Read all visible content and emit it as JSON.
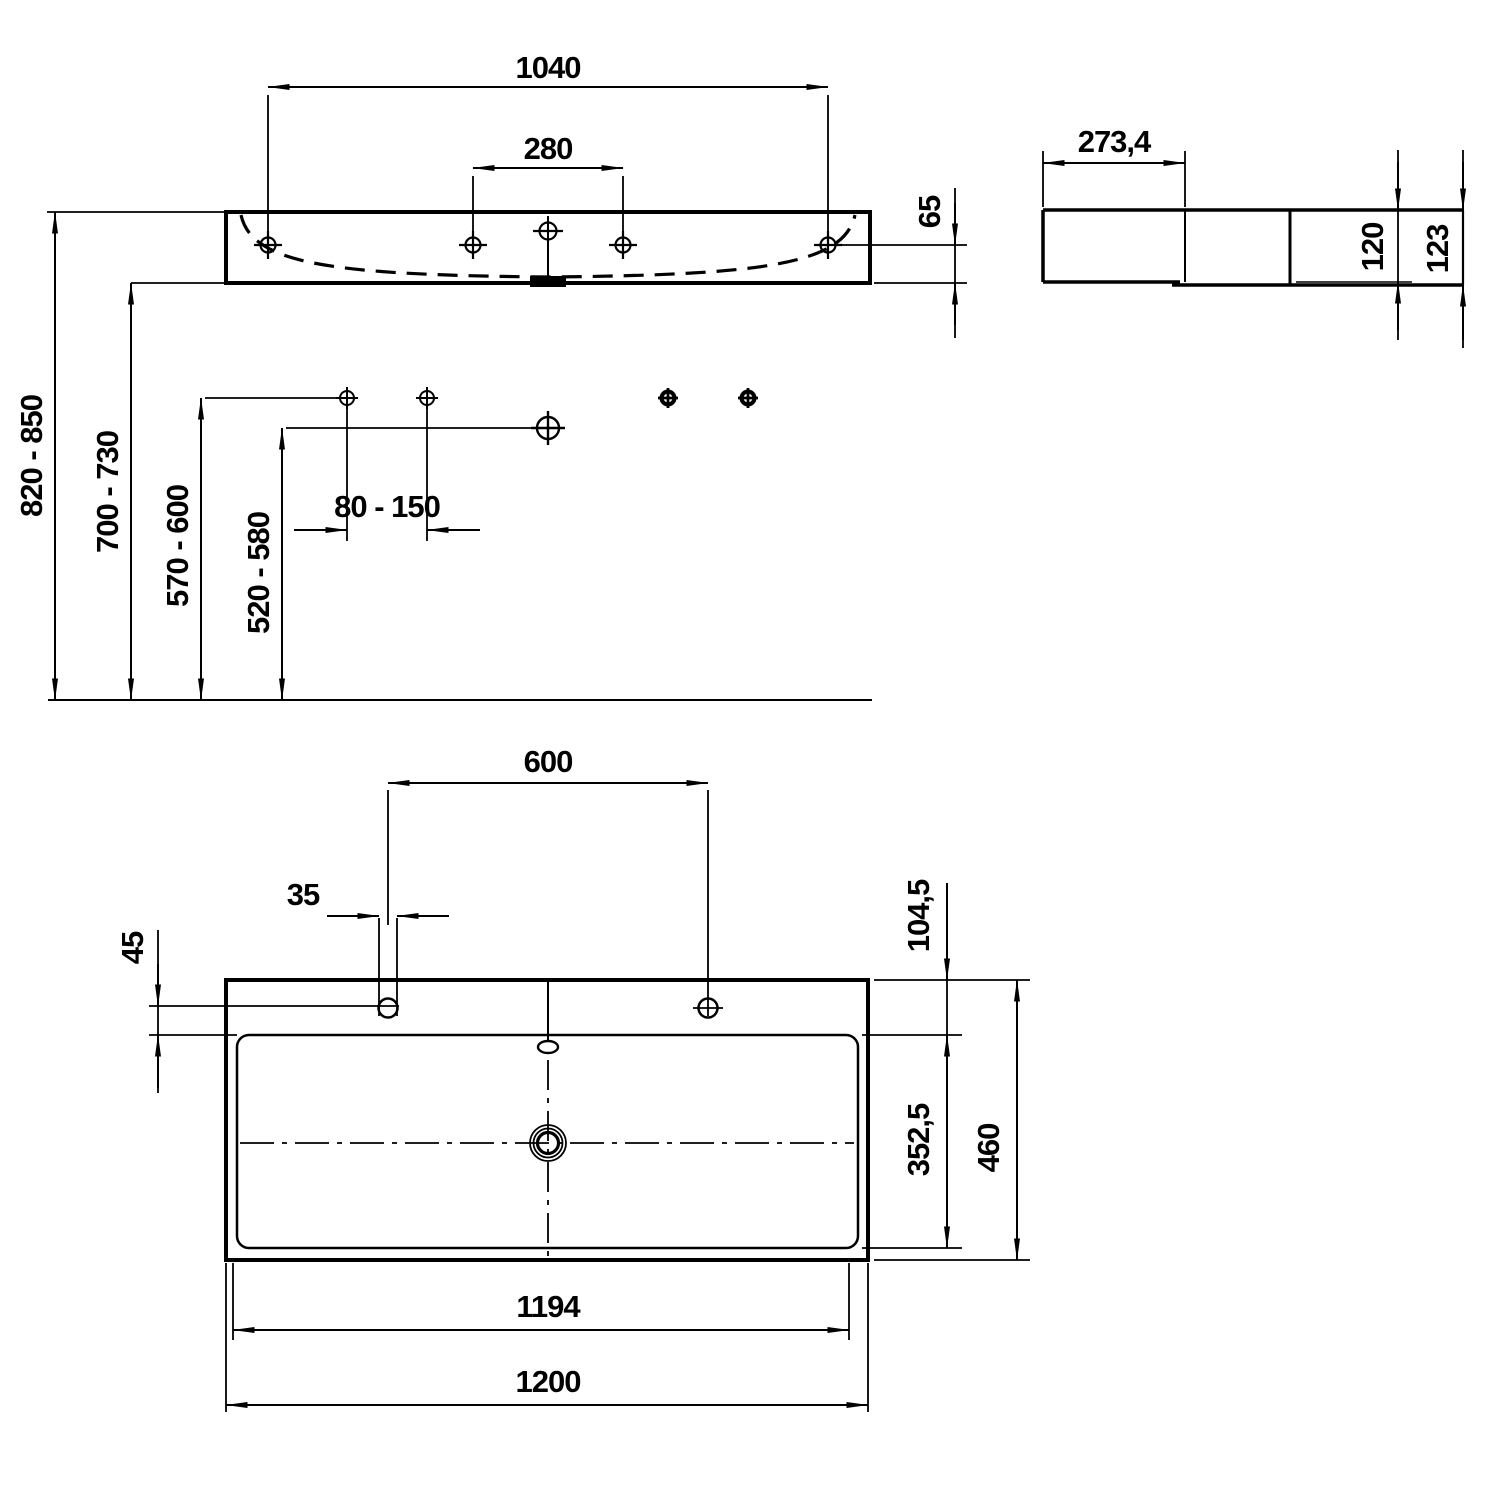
{
  "drawing": {
    "kind": "technical-dimension-drawing",
    "subject": "wall-mounted washbasin",
    "units": "mm",
    "line_color": "#000000",
    "background": "#ffffff",
    "views": {
      "front": {
        "name": "front-elevation",
        "dims": {
          "fixing_hole_span": "1040",
          "center_hole_span": "280",
          "hole_to_bottom": "65",
          "rim_height_range": "820 - 850",
          "underside_height_range": "700 - 730",
          "upper_fixing_height_range": "570 - 600",
          "drain_height_range": "520 - 580",
          "fixing_offset_range": "80 - 150"
        }
      },
      "side": {
        "name": "side-profile",
        "dims": {
          "bowl_depth": "273,4",
          "body_height": "120",
          "overall_height": "123"
        }
      },
      "plan": {
        "name": "plan-top-view",
        "dims": {
          "tap_hole_spacing": "600",
          "tap_hole_diameter": "35",
          "tap_hole_edge_offset": "45",
          "deck_depth": "104,5",
          "bowl_inner_depth": "352,5",
          "overall_depth": "460",
          "bottom_length": "1194",
          "overall_length": "1200"
        }
      }
    }
  }
}
